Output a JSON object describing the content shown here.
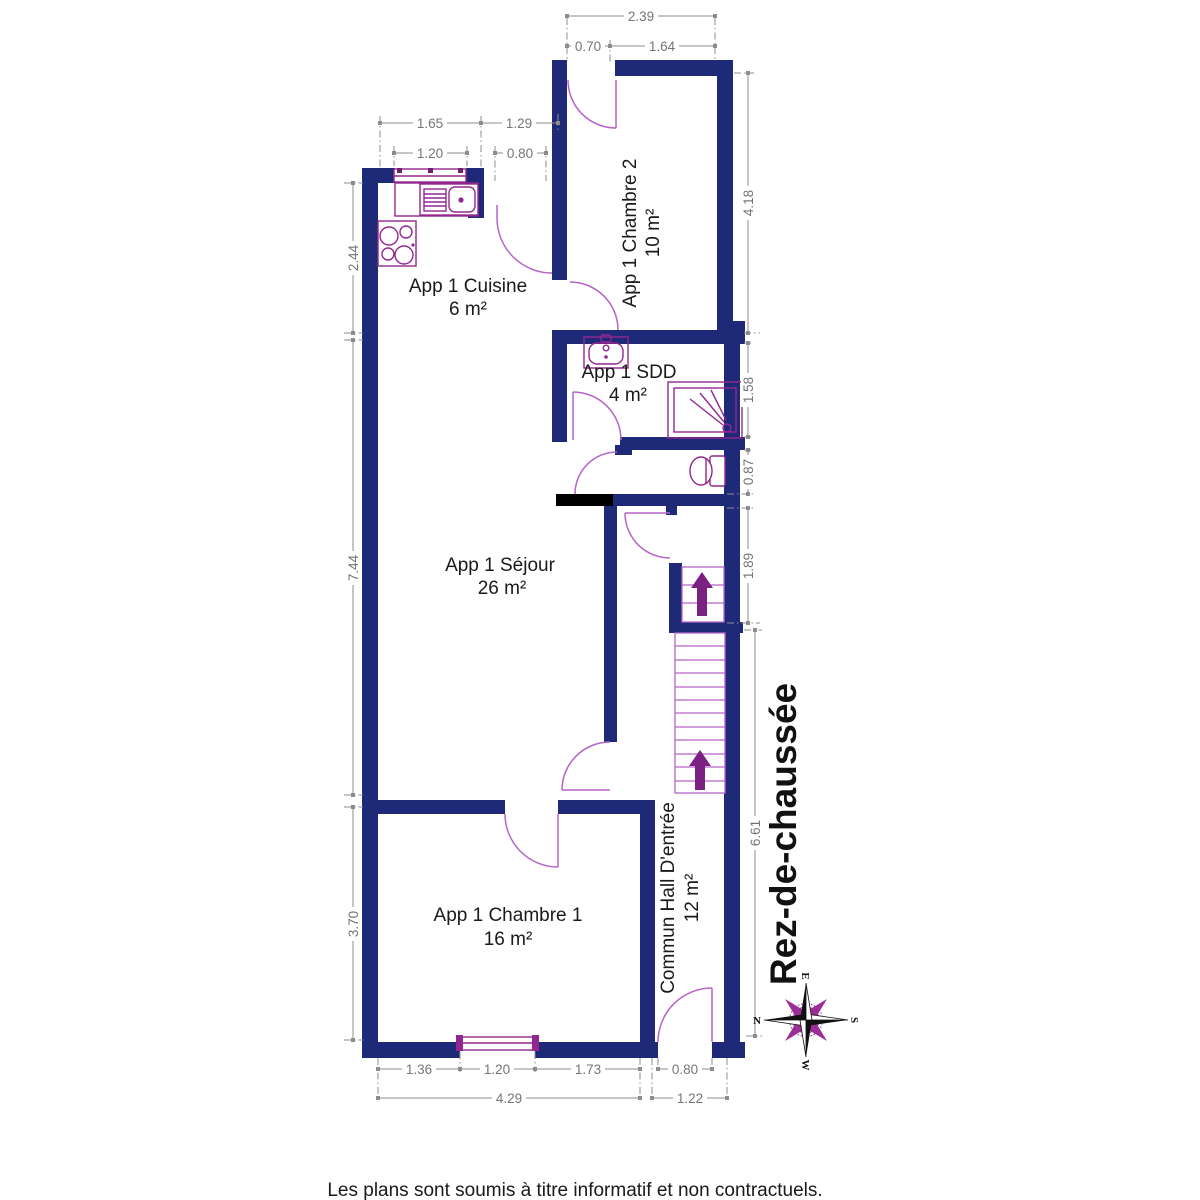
{
  "page": {
    "floor_title": "Rez-de-chaussée",
    "disclaimer": "Les plans sont soumis à titre informatif et non contractuels."
  },
  "rooms": {
    "cuisine": {
      "name": "App 1 Cuisine",
      "area": "6 m²"
    },
    "chambre2": {
      "name": "App 1 Chambre 2",
      "area": "10 m²"
    },
    "sdd": {
      "name": "App 1 SDD",
      "area": "4 m²"
    },
    "sejour": {
      "name": "App 1 Séjour",
      "area": "26 m²"
    },
    "chambre1": {
      "name": "App 1 Chambre 1",
      "area": "16 m²"
    },
    "hall": {
      "name": "Commun Hall D'entrée",
      "area": "12 m²"
    }
  },
  "dims": {
    "top_total": "2.39",
    "top_door": "0.70",
    "top_window_side": "1.64",
    "kitchen_left": "1.65",
    "kitchen_right": "1.29",
    "kitchen_window": "1.20",
    "kitchen_door": "0.80",
    "left_kitchen": "2.44",
    "left_sejour": "7.44",
    "left_chambre1": "3.70",
    "right_chambre2": "4.18",
    "right_sdd": "1.58",
    "right_wc": "0.87",
    "right_stairs": "1.89",
    "right_hall": "6.61",
    "bottom_left": "1.36",
    "bottom_window": "1.20",
    "bottom_right": "1.73",
    "bottom_total": "4.29",
    "hall_door": "0.80",
    "hall_total": "1.22"
  },
  "compass": {
    "north": "N",
    "south": "S",
    "east": "E",
    "west": "W"
  },
  "colors": {
    "wall": "#1e2a78",
    "fixture": "#93278f",
    "door_arc": "#b564c8",
    "stair_arrow": "#7a2182",
    "dimension_line": "#8c8c8c",
    "dimension_text": "#757575",
    "label_text": "#1a1a1a",
    "special_wall": "#000000"
  }
}
